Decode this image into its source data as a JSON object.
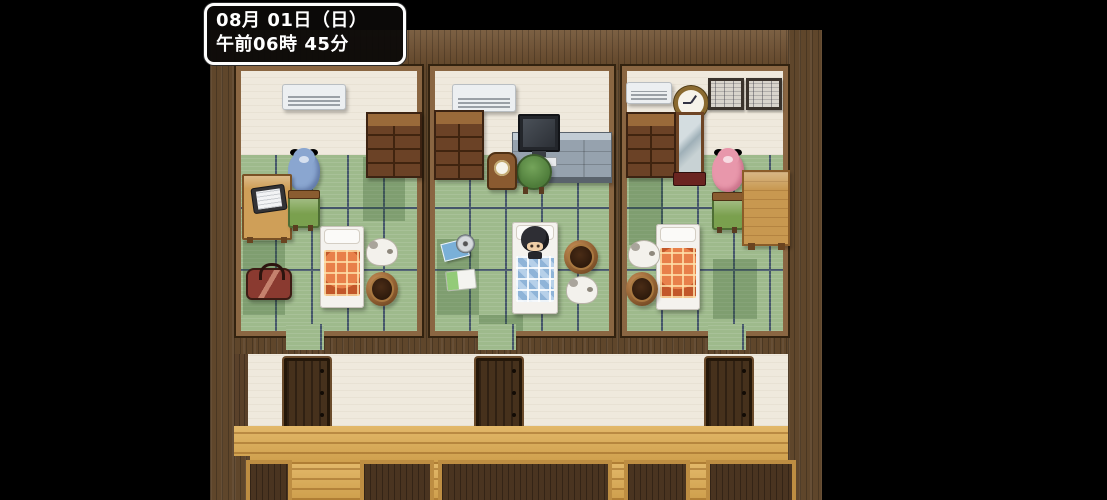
{
  "hud": {
    "date_line": "08月 01日（日）",
    "time_line": "午前06時 45分"
  },
  "scene": {
    "view": "top-down interior of three tatami bedrooms above a hallway",
    "rooms": [
      {
        "name": "left-bedroom",
        "objects": [
          "air-conditioner",
          "dresser",
          "blue-teddy-bear",
          "desk-with-laptop",
          "green-chair",
          "bed-orange-blanket",
          "sleeping-dog",
          "woven-basket",
          "red-bag"
        ]
      },
      {
        "name": "middle-bedroom",
        "objects": [
          "air-conditioner",
          "dresser",
          "computer-desk",
          "monitor",
          "green-stool",
          "alarm-clock",
          "cd-discs",
          "white-book",
          "bed-blue-blanket-with-sleeping-character",
          "woven-basket",
          "sleeping-dog"
        ]
      },
      {
        "name": "right-bedroom",
        "objects": [
          "air-conditioner",
          "wall-clock",
          "framed-picture",
          "framed-picture",
          "dresser",
          "standing-mirror",
          "pink-teddy-bear",
          "green-chair",
          "low-table",
          "bed-orange-blanket",
          "sleeping-dog",
          "woven-basket"
        ]
      }
    ],
    "hallway": {
      "doors": 3,
      "floor": "wooden-planks"
    }
  },
  "palette": {
    "background": "#000000",
    "wall_wood": "#5f462b",
    "room_frame": "#8a6642",
    "plaster_wall": "#efe9dd",
    "tatami_green": "#9eba8c",
    "tatami_line": "#45566a",
    "hall_floor": "#d9a750",
    "door_wood": "#46311c",
    "hud_border": "#ffffff",
    "hud_background": "#0c0a08",
    "hud_text": "#ffffff"
  }
}
